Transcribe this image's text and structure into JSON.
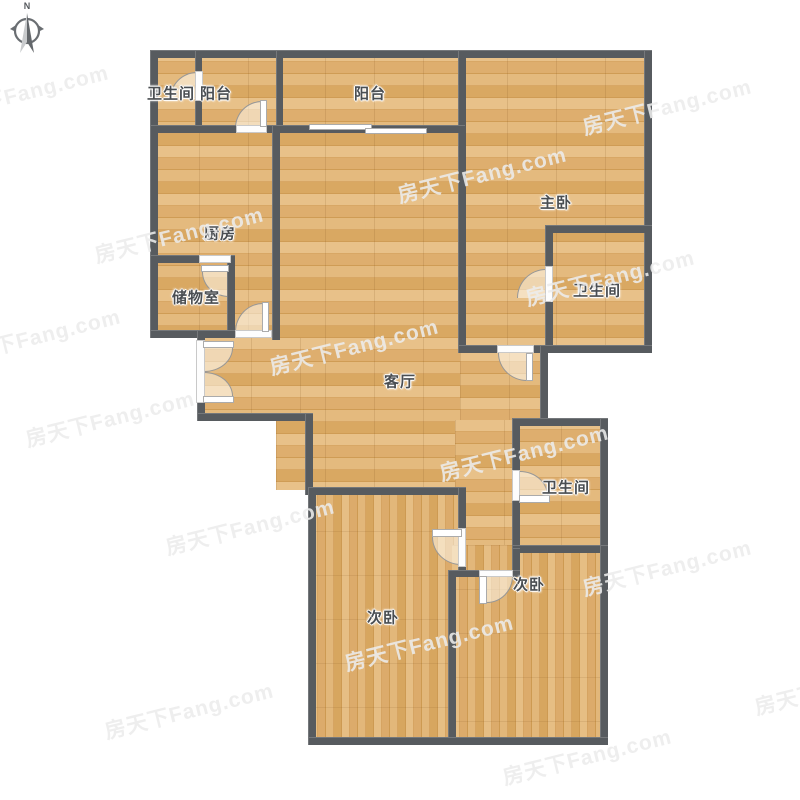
{
  "compass": {
    "label": "N"
  },
  "rooms": {
    "bath_top_left": {
      "label": "卫生间"
    },
    "balcony_small": {
      "label": "阳台"
    },
    "balcony_main": {
      "label": "阳台"
    },
    "master_bedroom": {
      "label": "主卧"
    },
    "kitchen": {
      "label": "厨房"
    },
    "master_bath": {
      "label": "卫生间"
    },
    "storage": {
      "label": "储物室"
    },
    "living_room": {
      "label": "客厅"
    },
    "bath_mid": {
      "label": "卫生间"
    },
    "bedroom_left": {
      "label": "次卧"
    },
    "bedroom_right": {
      "label": "次卧"
    }
  },
  "watermark": {
    "text": "房天下Fang.com",
    "color": "rgba(236,236,236,0.88)",
    "positions": [
      [
        -60,
        98
      ],
      [
        583,
        112
      ],
      [
        95,
        240
      ],
      [
        398,
        180
      ],
      [
        -48,
        342
      ],
      [
        270,
        352
      ],
      [
        526,
        283
      ],
      [
        26,
        424
      ],
      [
        440,
        458
      ],
      [
        166,
        532
      ],
      [
        345,
        648
      ],
      [
        583,
        573
      ],
      [
        105,
        716
      ],
      [
        503,
        762
      ],
      [
        755,
        692
      ]
    ]
  },
  "colors": {
    "wall": "#575b5f",
    "wood": "#dfb173",
    "background": "#ffffff"
  }
}
